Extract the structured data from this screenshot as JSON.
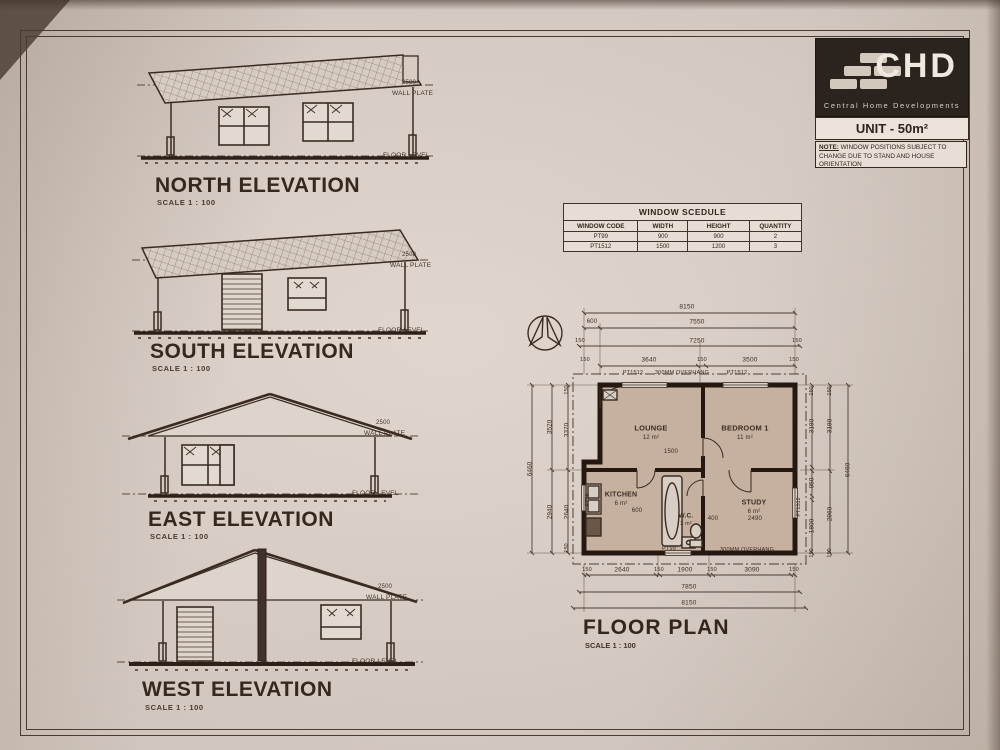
{
  "brand": {
    "name": "CHD",
    "tagline": "Central Home Developments",
    "unit_label": "UNIT - 50m²",
    "note_label": "NOTE:",
    "note_text": " WINDOW POSITIONS SUBJECT TO CHANGE DUE TO STAND AND HOUSE ORIENTATION"
  },
  "annotations": {
    "wall_plate_value": "2500",
    "wall_plate": "WALL PLATE",
    "floor_level": "FLOOR LEVEL"
  },
  "elevations": [
    {
      "title": "NORTH ELEVATION",
      "scale": "SCALE 1 : 100"
    },
    {
      "title": "SOUTH ELEVATION",
      "scale": "SCALE 1 : 100"
    },
    {
      "title": "EAST ELEVATION",
      "scale": "SCALE 1 : 100"
    },
    {
      "title": "WEST ELEVATION",
      "scale": "SCALE 1 : 100"
    }
  ],
  "window_schedule": {
    "title": "WINDOW SCEDULE",
    "headers": [
      "WINDOW CODE",
      "WIDTH",
      "HEIGHT",
      "QUANTITY"
    ],
    "rows": [
      {
        "code": "PT99",
        "width": "900",
        "height": "900",
        "qty": "2"
      },
      {
        "code": "PT1512",
        "width": "1500",
        "height": "1200",
        "qty": "3"
      }
    ]
  },
  "floor_plan": {
    "title": "FLOOR PLAN",
    "scale": "SCALE 1 : 100",
    "rooms": {
      "lounge": {
        "name": "LOUNGE",
        "area": "12 m²"
      },
      "bedroom": {
        "name": "BEDROOM 1",
        "area": "11 m²"
      },
      "kitchen": {
        "name": "KITCHEN",
        "area": "6 m²"
      },
      "wc": {
        "name": "W.C.",
        "area": "3 m²"
      },
      "study": {
        "name": "STUDY",
        "area": "6 m²"
      }
    },
    "dims": {
      "tick": "150",
      "top": {
        "overall": "8150",
        "step": "600",
        "row2": "7550",
        "row3": "7250",
        "left": "3640",
        "right": "3500"
      },
      "bottom": {
        "seg1": "2640",
        "seg2": "1900",
        "seg3": "3090",
        "row2": "7850",
        "overall": "8150"
      },
      "left": {
        "overall": "6460",
        "outer_top": "3520",
        "outer_bottom": "2940",
        "inner_top": "3370",
        "inner_bottom": "2640"
      },
      "right": {
        "overall": "6460",
        "col1_top": "3190",
        "col1_mid": "950",
        "col1_bottom": "1800",
        "col2_top": "3190",
        "col2_bottom": "2960"
      },
      "interior": {
        "opening": "1500",
        "kitchen_door": "600",
        "study_left": "400",
        "study_width": "2490"
      }
    },
    "wall_labels": {
      "top_window_left": "PT1512",
      "top_overhang": "300MM OVERHANG",
      "top_window_right": "PT1512",
      "bottom_window": "PT99",
      "bottom_overhang": "300MM OVERHANG",
      "left_window": "PT99",
      "right_window": "PT1512"
    }
  }
}
